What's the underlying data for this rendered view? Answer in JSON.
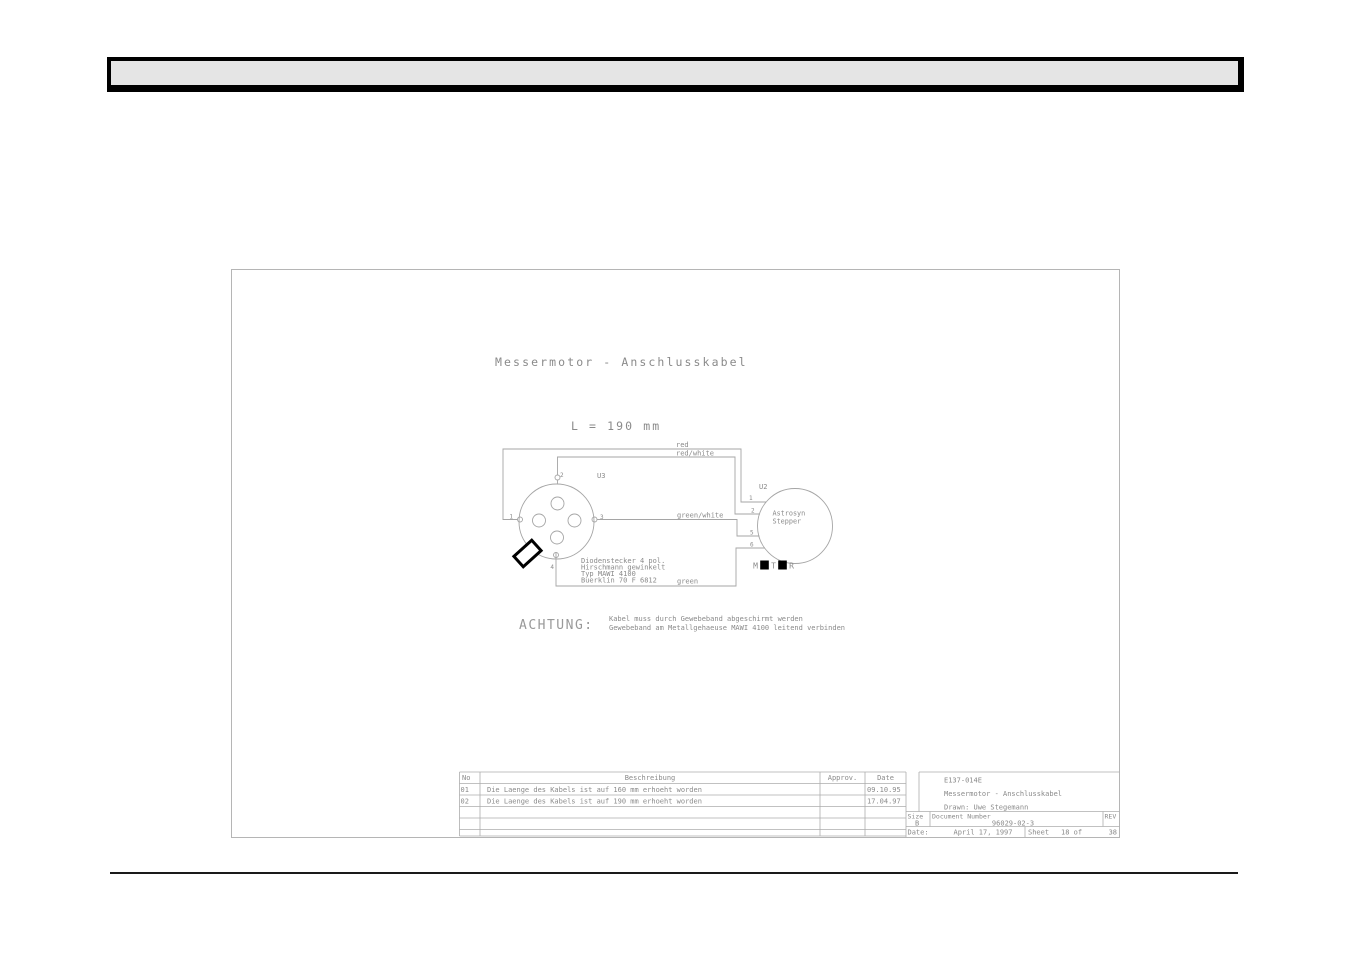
{
  "drawing": {
    "title": "Messermotor - Anschlusskabel",
    "length_label": "L = 190 mm",
    "wires": {
      "red": "red",
      "red_white": "red/white",
      "green_white": "green/white",
      "green": "green"
    },
    "connector": {
      "refdes": "U3",
      "pins": [
        "1",
        "2",
        "3",
        "4"
      ],
      "note_lines": [
        "Diodenstecker 4 pol.",
        "Hirschmann gewinkelt",
        "Typ MAWI 4100",
        "Buerklin 70 F 6812"
      ]
    },
    "stepper": {
      "refdes": "U2",
      "name_line1": "Astrosyn",
      "name_line2": "Stepper",
      "pins": [
        "1",
        "2",
        "5",
        "6"
      ],
      "motor_chars": [
        "M",
        "O",
        "T",
        "O",
        "R"
      ]
    },
    "caution": {
      "heading": "ACHTUNG:",
      "line1": "Kabel muss durch Gewebeband abgeschirmt werden",
      "line2": "Gewebeband am Metallgehaeuse MAWI 4100 leitend verbinden"
    },
    "revision_table": {
      "headers": {
        "no": "No",
        "description": "Beschreibung",
        "approv": "Approv.",
        "date": "Date"
      },
      "rows": [
        {
          "no": "01",
          "description": "Die Laenge des Kabels ist auf 160 mm erhoeht worden",
          "approv": "",
          "date": "09.10.95"
        },
        {
          "no": "02",
          "description": "Die Laenge des Kabels ist auf 190 mm erhoeht worden",
          "approv": "",
          "date": "17.04.97"
        }
      ]
    },
    "title_block": {
      "doc_code": "E137-014E",
      "doc_title": "Messermotor - Anschlusskabel",
      "drawn": "Drawn: Uwe Stegemann",
      "size_label": "Size",
      "size_value": "B",
      "document_number_label": "Document Number",
      "document_number": "96029-02-3",
      "rev_label": "REV",
      "date_label": "Date:",
      "date_value": "April 17, 1997",
      "sheet_label": "Sheet",
      "sheet_value": "18 of",
      "total_sheets": "38"
    }
  },
  "colors": {
    "line_gray": "#a5a5a5",
    "text_gray": "#8a8a8a",
    "black": "#000000",
    "header_fill": "#e5e5e5"
  }
}
